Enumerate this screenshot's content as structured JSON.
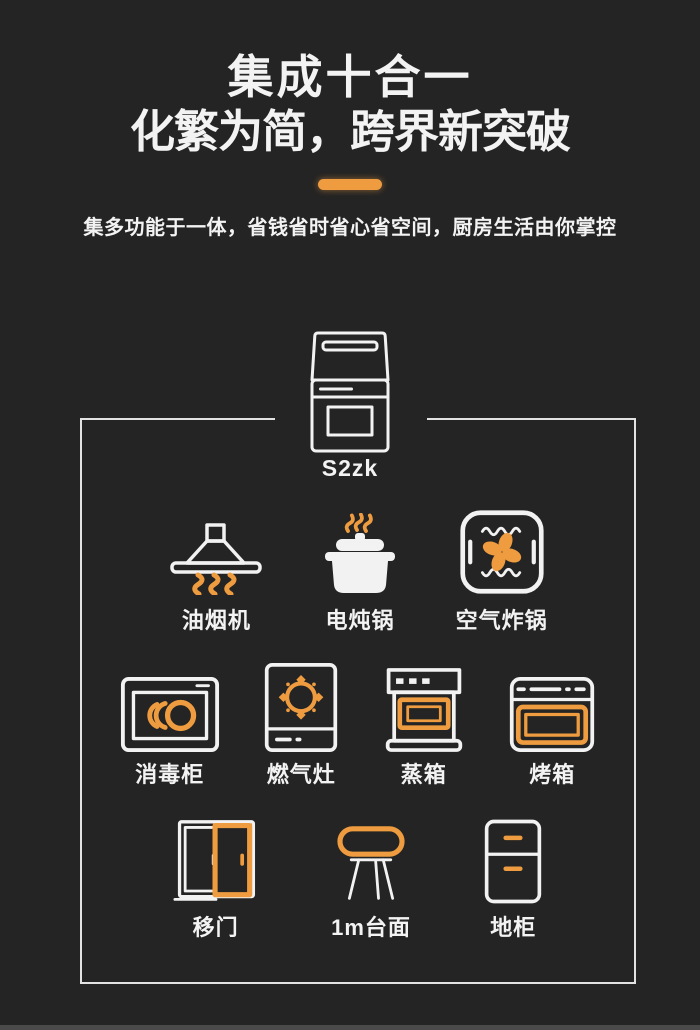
{
  "colors": {
    "accent": "#EE9C3F",
    "background": "#242424",
    "text": "#F3F3F3",
    "frame_border": "#E2E2E2",
    "bottom_strip": "#4A4A4A"
  },
  "header": {
    "title_line1": "集成十合一",
    "title_line2": "化繁为简，跨界新突破",
    "divider_icon": "orange-divider-bar",
    "subtitle": "集多功能于一体，省钱省时省心省空间，厨房生活由你掌控"
  },
  "product": {
    "icon": "integrated-stove-icon",
    "model": "S2zk"
  },
  "grid": {
    "rows": [
      {
        "items": [
          {
            "label": "油烟机",
            "icon": "range-hood-icon"
          },
          {
            "label": "电炖锅",
            "icon": "stew-pot-icon"
          },
          {
            "label": "空气炸锅",
            "icon": "air-fryer-icon"
          }
        ]
      },
      {
        "items": [
          {
            "label": "消毒柜",
            "icon": "disinfection-cabinet-icon"
          },
          {
            "label": "燃气灶",
            "icon": "gas-stove-icon"
          },
          {
            "label": "蒸箱",
            "icon": "steam-oven-icon"
          },
          {
            "label": "烤箱",
            "icon": "oven-icon"
          }
        ]
      },
      {
        "items": [
          {
            "label": "移门",
            "icon": "sliding-door-icon"
          },
          {
            "label": "1m台面",
            "icon": "countertop-icon"
          },
          {
            "label": "地柜",
            "icon": "floor-cabinet-icon"
          }
        ]
      }
    ]
  }
}
